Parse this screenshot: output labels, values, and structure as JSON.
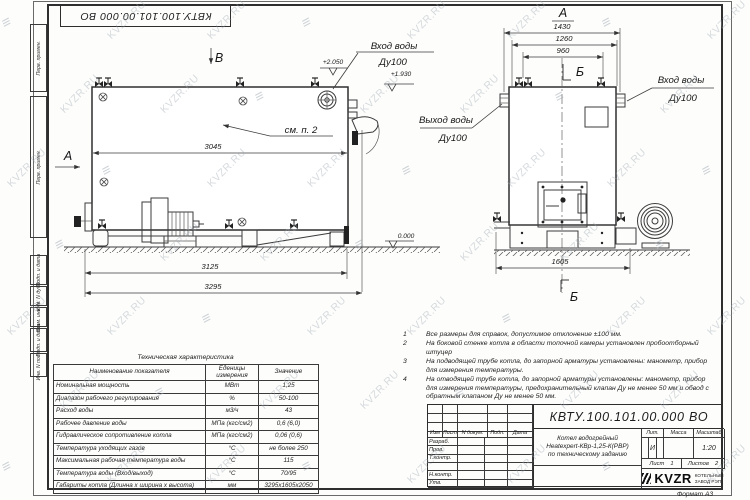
{
  "watermark": {
    "text": "KVZR.RU"
  },
  "frame": {
    "top_designation": "КВТУ.100.101.00.000  ВО",
    "left_boxes_top": [
      {
        "label": "Перв. примен."
      },
      {
        "label": "Перв. примен."
      }
    ],
    "left_boxes_bottom": [
      {
        "label": "Подп. и дата"
      },
      {
        "label": "Инв. N дубл."
      },
      {
        "label": "Взам. инв. N"
      },
      {
        "label": "Подп. и дата"
      },
      {
        "label": "Инв. N подл."
      }
    ],
    "format_note": "Формат   А3"
  },
  "views": {
    "side": {
      "label_b": "В",
      "label_a": "А",
      "see_note": "см. п. 2",
      "dim_3045": "3045",
      "dim_3125": "3125",
      "dim_3295": "3295",
      "elev_1": "+2.050",
      "elev_2": "+1.930",
      "elev_zero": "0.000",
      "inlet_line1": "Вход воды",
      "inlet_line2": "Ду100"
    },
    "front": {
      "label_a": "А",
      "label_b": "Б",
      "dim_1430": "1430",
      "dim_1260": "1260",
      "dim_960": "960",
      "dim_1605": "1605",
      "outlet_line1": "Выход воды",
      "outlet_line2": "Ду100",
      "inlet_line1": "Вход воды",
      "inlet_line2": "Ду100"
    }
  },
  "tech_table": {
    "title": "Техническая характеристика",
    "headers": [
      "Наименование показателя",
      "Еденицы\nизмерения",
      "Значение"
    ],
    "rows": [
      [
        "Номинальная мощность",
        "МВт",
        "1,25"
      ],
      [
        "Диапазон рабочего регулирования",
        "%",
        "50-100"
      ],
      [
        "Расход воды",
        "м3/ч",
        "43"
      ],
      [
        "Рабочее давление воды",
        "МПа (кгс/см2)",
        "0,6 (6,0)"
      ],
      [
        "Гидравлическое сопротивление котла",
        "МПа (кгс/см2)",
        "0,06 (0,6)"
      ],
      [
        "Температура уходящих газов",
        "°С",
        "не более 250"
      ],
      [
        "Максимальная рабочая температура воды",
        "°С",
        "115"
      ],
      [
        "Температура воды (Вход/выход)",
        "°С",
        "70/95"
      ],
      [
        "Габариты котла (Длинна х ширина х высота)",
        "мм",
        "3295х1605х2050"
      ]
    ]
  },
  "notes": [
    {
      "num": "1",
      "text": "Все размеры для справок, допустимое отклонение  ±100 мм."
    },
    {
      "num": "2",
      "text": "На боковой стенке котла в области топочной камеры установлен пробоотборный штуцер"
    },
    {
      "num": "3",
      "text": "На  подводящей трубе котла, до запорной арматуры установлены: манометр, прибор для измерения температуры."
    },
    {
      "num": "4",
      "text": "На отводящей трубе котла, до запорной арматуры установлены: манометр, прибор для измерения температуры, предохранительный клапан Ду не менее 50 мм и обвод с обратным клапаном Ду не менее 50 мм."
    }
  ],
  "title_block": {
    "designation": "КВТУ.100.101.00.000  ВО",
    "header_cols": [
      "Изм",
      "Лист",
      "N докум.",
      "Подп.",
      "Дата"
    ],
    "rows": [
      "Разраб.",
      "Пров.",
      "Т.контр.",
      "",
      "Н.контр.",
      "Утв."
    ],
    "doc_name_lines": [
      "Котел водогрейный",
      "Heatexpert-КВр-1,25-К(РВР)",
      "по техническому заданию"
    ],
    "lit_header": "Лит.",
    "mass_header": "Масса",
    "scale_header": "Масштаб",
    "lit_value": "И",
    "scale_value": "1:20",
    "sheet_label": "Лист",
    "sheet_value": "1",
    "sheets_label": "Листов",
    "sheets_value": "2",
    "company_logo": "KVZR",
    "company_line1": "КОТЕЛЬНЫЙ",
    "company_line2": "ЗАВОД РЭП"
  }
}
